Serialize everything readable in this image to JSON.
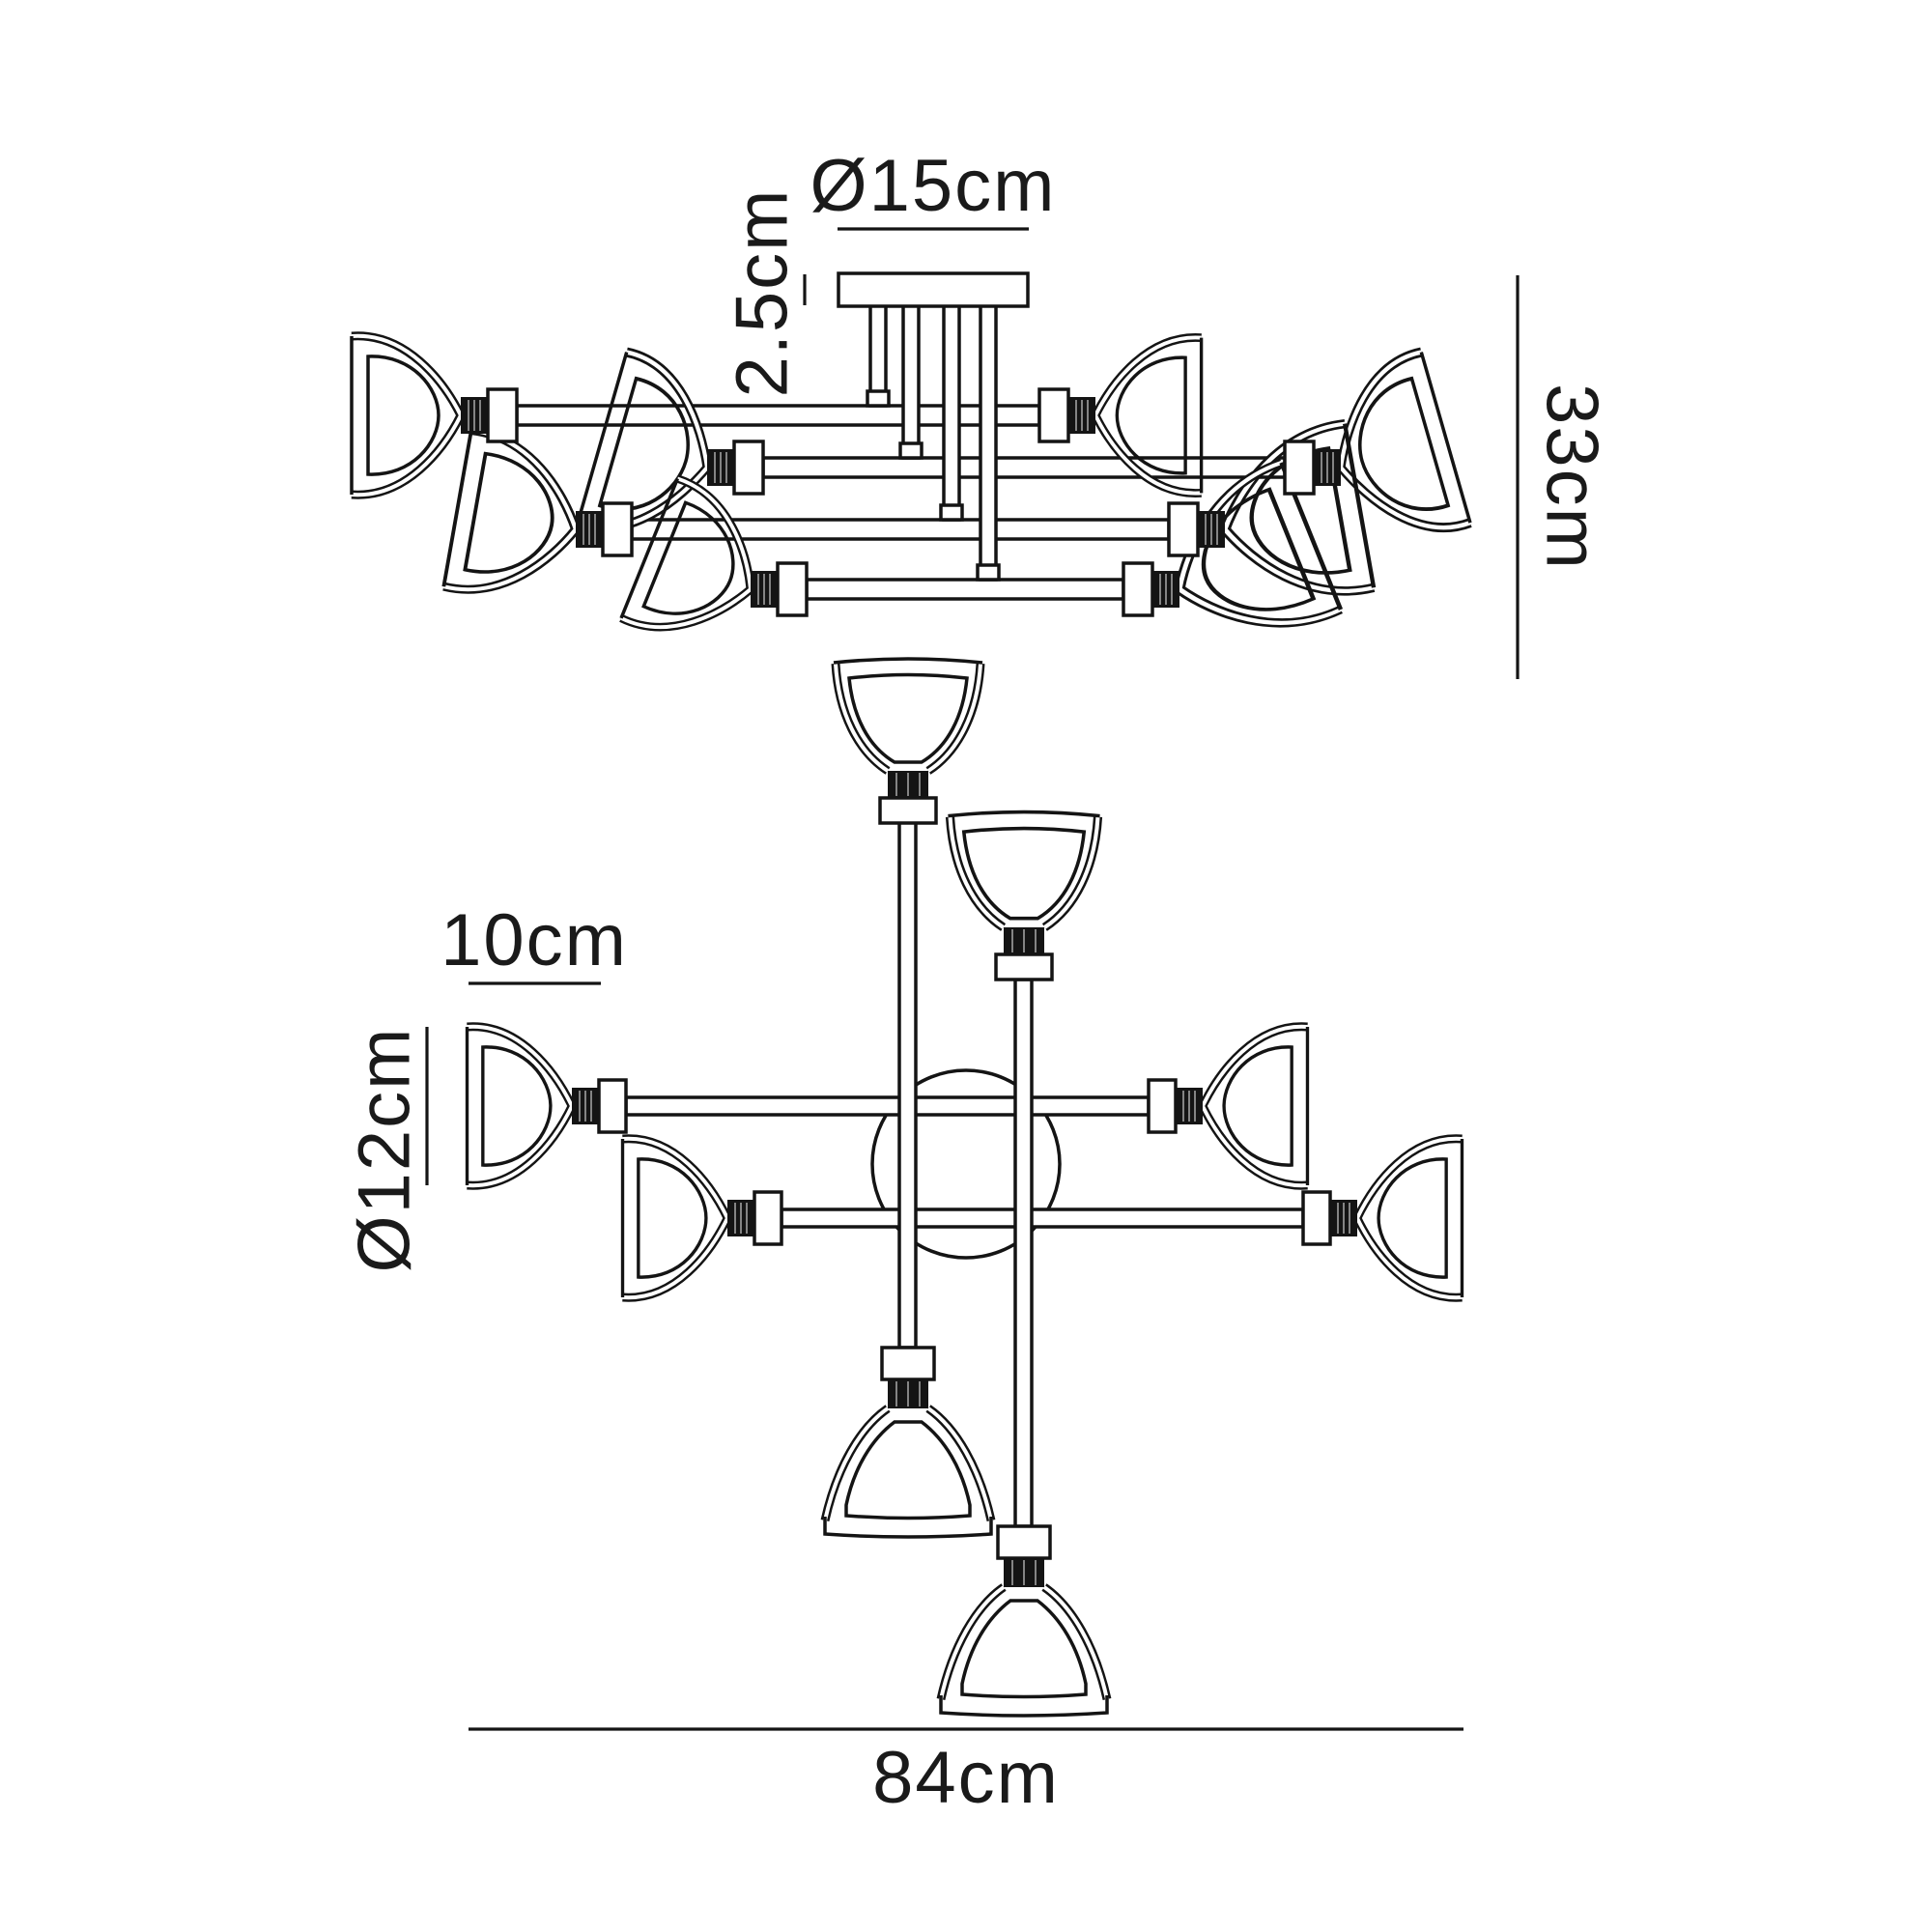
{
  "meta": {
    "background_color": "#ffffff",
    "line_color": "#141414",
    "text_color": "#1a1a1a"
  },
  "diagram": {
    "type": "product-dimension-drawing",
    "subject": "multi-arm ceiling light fixture shown in two line-drawing views",
    "views": [
      {
        "id": "side-elevation",
        "description": "semi-flush fixture seen from the side, ceiling plate with drop rods and 8 trumpet shades",
        "shade_count": 8
      },
      {
        "id": "plan-view",
        "description": "fixture seen from below, pinwheel cross of arms with 8 shades and central canopy circle",
        "shade_count": 8
      }
    ],
    "units": "cm"
  },
  "labels": {
    "d15": {
      "text": "Ø15cm",
      "measures": "ceiling-plate diameter",
      "orientation": "horizontal"
    },
    "d25": {
      "text": "2.5cm",
      "measures": "ceiling-plate depth",
      "orientation": "vertical"
    },
    "d33": {
      "text": "33cm",
      "measures": "overall fixture height",
      "orientation": "vertical"
    },
    "d10": {
      "text": "10cm",
      "measures": "shade depth",
      "orientation": "horizontal"
    },
    "d12": {
      "text": "Ø12cm",
      "measures": "shade diameter",
      "orientation": "vertical"
    },
    "d84": {
      "text": "84cm",
      "measures": "overall fixture width",
      "orientation": "horizontal"
    }
  }
}
